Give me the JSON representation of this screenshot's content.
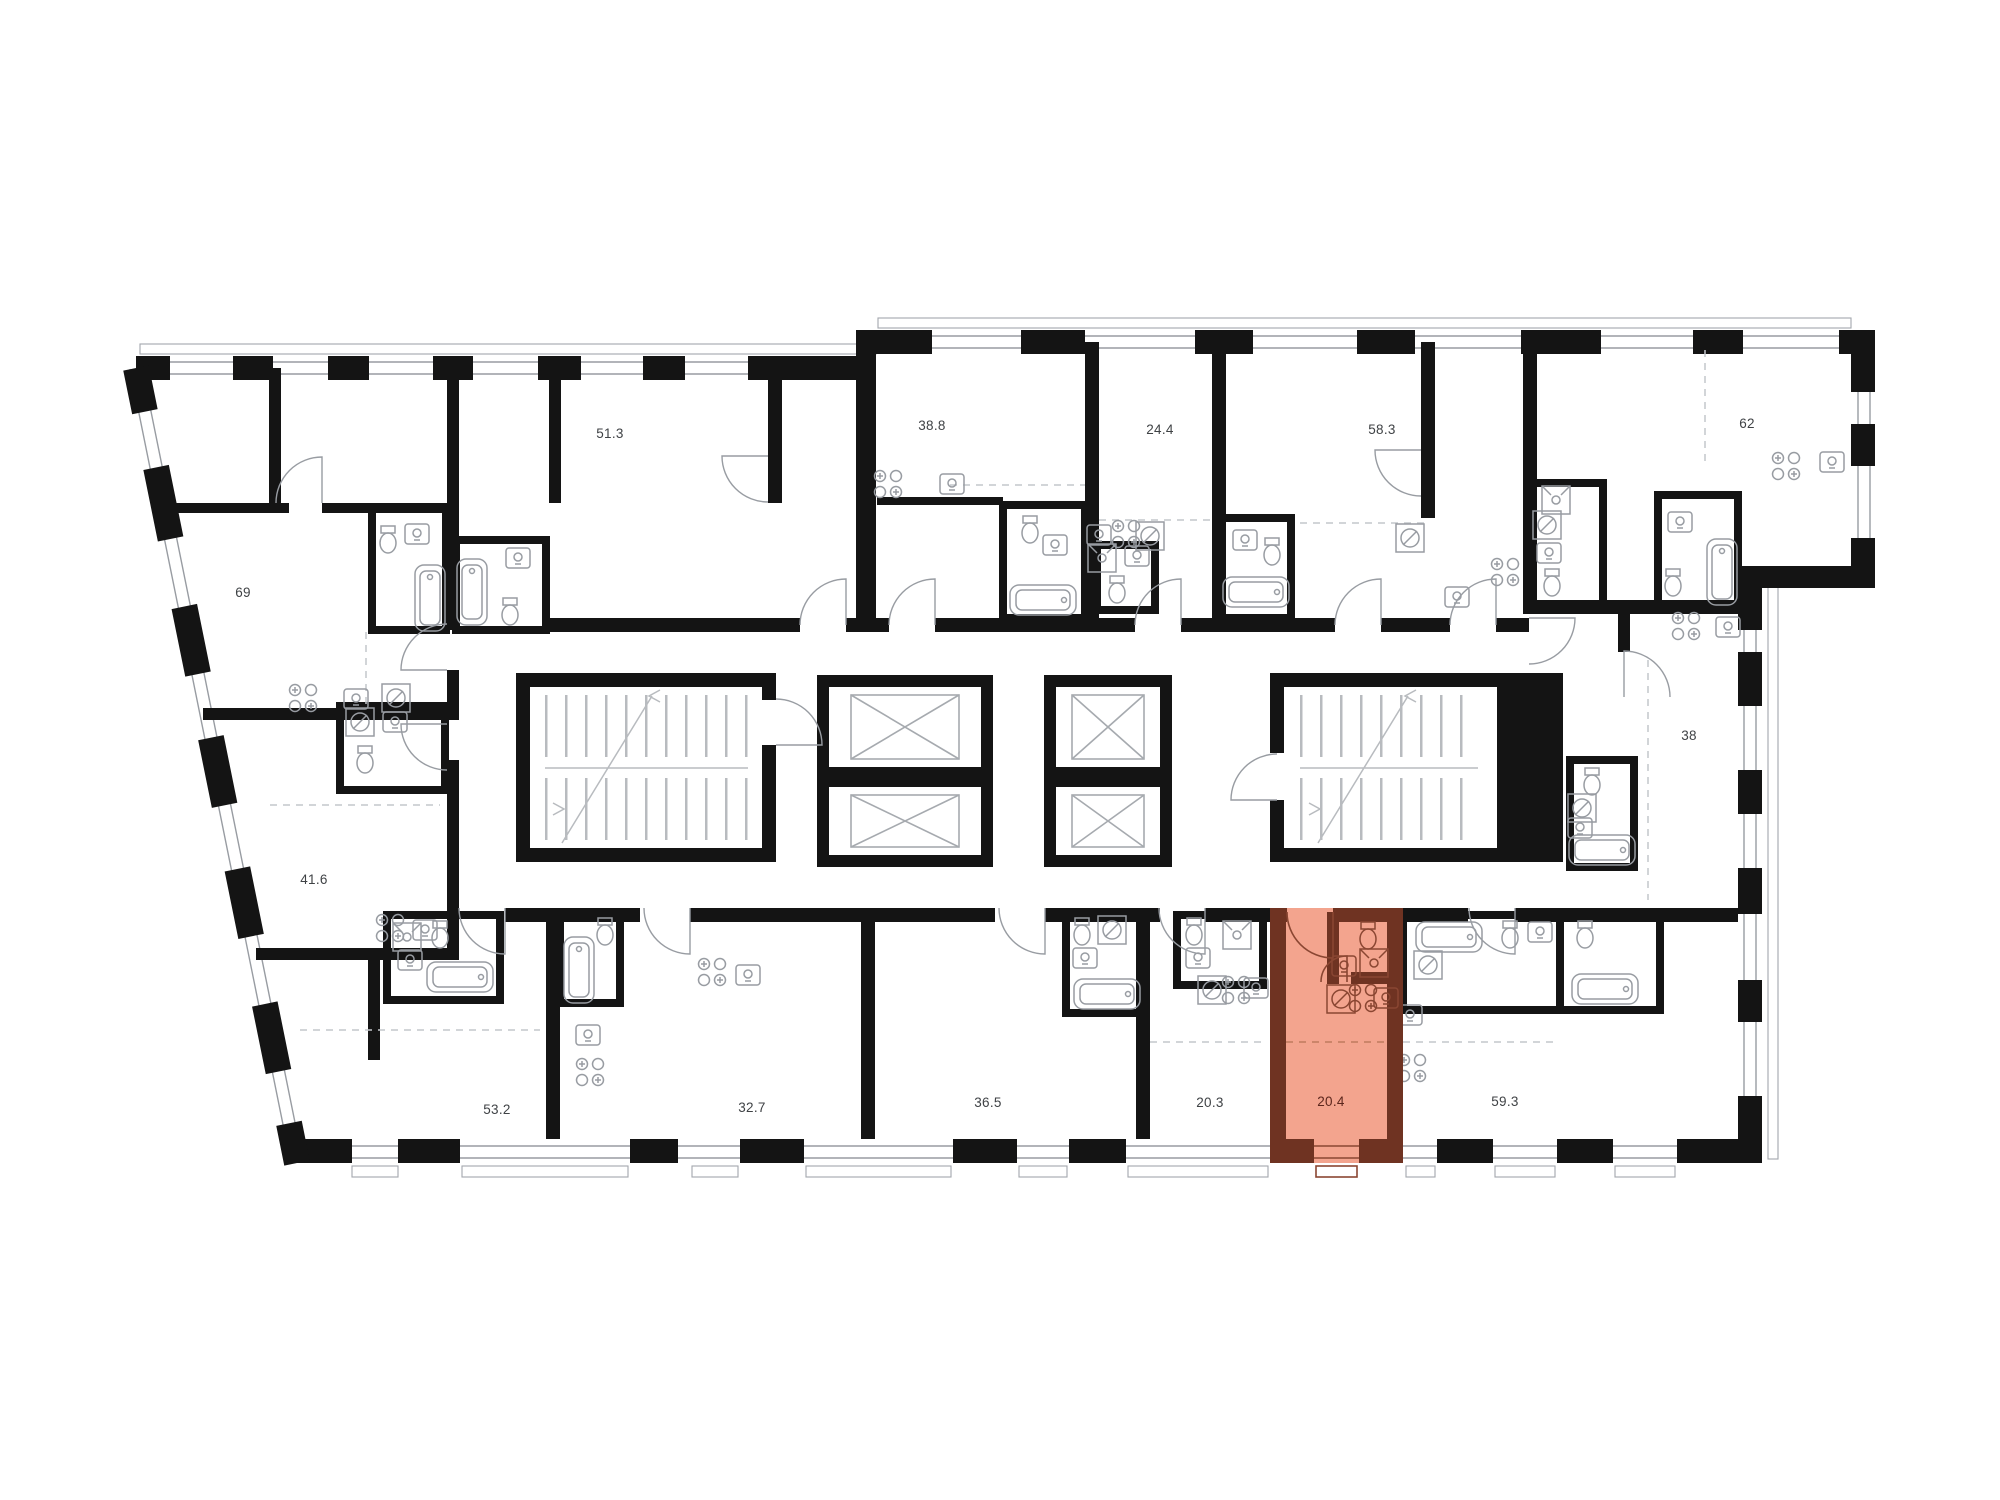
{
  "plan": {
    "type": "residential-floor-plan",
    "background": "#FFFFFF",
    "wall_color": "#141414",
    "detail_color": "#989CA2",
    "label_color": "#3F4245",
    "highlight": {
      "fill": "#F3A48E",
      "wall": "#6F3322",
      "window": "#F9C3B2",
      "label_color": "#5C261C"
    },
    "selected_unit_area": "20.4",
    "units": [
      {
        "area": "69",
        "highlighted": false
      },
      {
        "area": "51.3",
        "highlighted": false
      },
      {
        "area": "38.8",
        "highlighted": false
      },
      {
        "area": "24.4",
        "highlighted": false
      },
      {
        "area": "58.3",
        "highlighted": false
      },
      {
        "area": "62",
        "highlighted": false
      },
      {
        "area": "41.6",
        "highlighted": false
      },
      {
        "area": "38",
        "highlighted": false
      },
      {
        "area": "53.2",
        "highlighted": false
      },
      {
        "area": "32.7",
        "highlighted": false
      },
      {
        "area": "36.5",
        "highlighted": false
      },
      {
        "area": "20.3",
        "highlighted": false
      },
      {
        "area": "20.4",
        "highlighted": true
      },
      {
        "area": "59.3",
        "highlighted": false
      }
    ]
  }
}
